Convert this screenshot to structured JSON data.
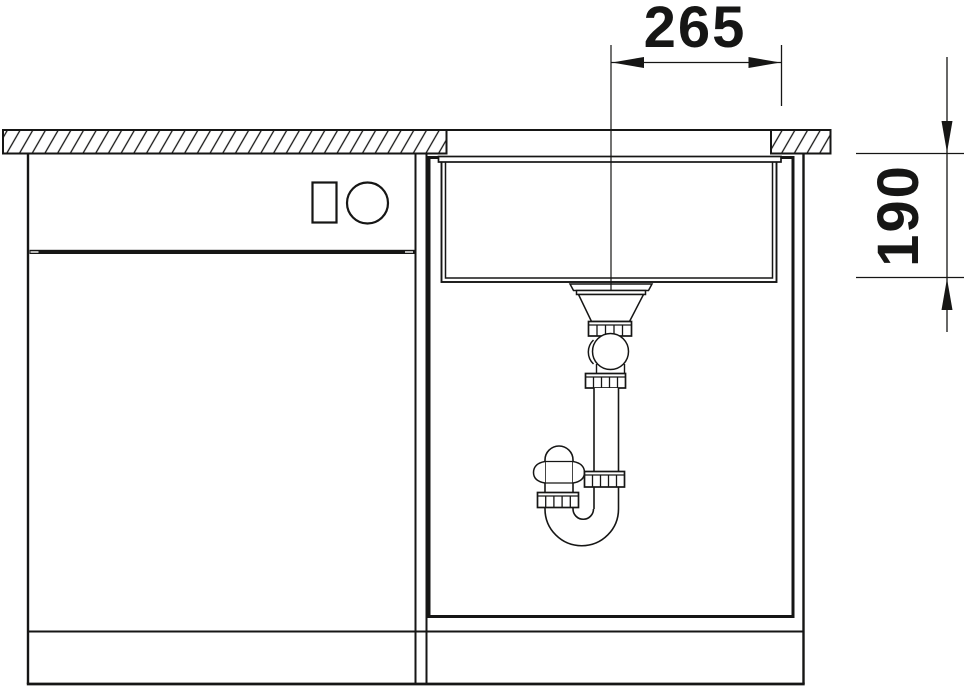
{
  "window": {
    "background": "#ffffff"
  },
  "drawing": {
    "line_color": "#161615",
    "annotations": {
      "dim_width": {
        "label": "265"
      },
      "dim_depth": {
        "label": "190"
      }
    }
  }
}
